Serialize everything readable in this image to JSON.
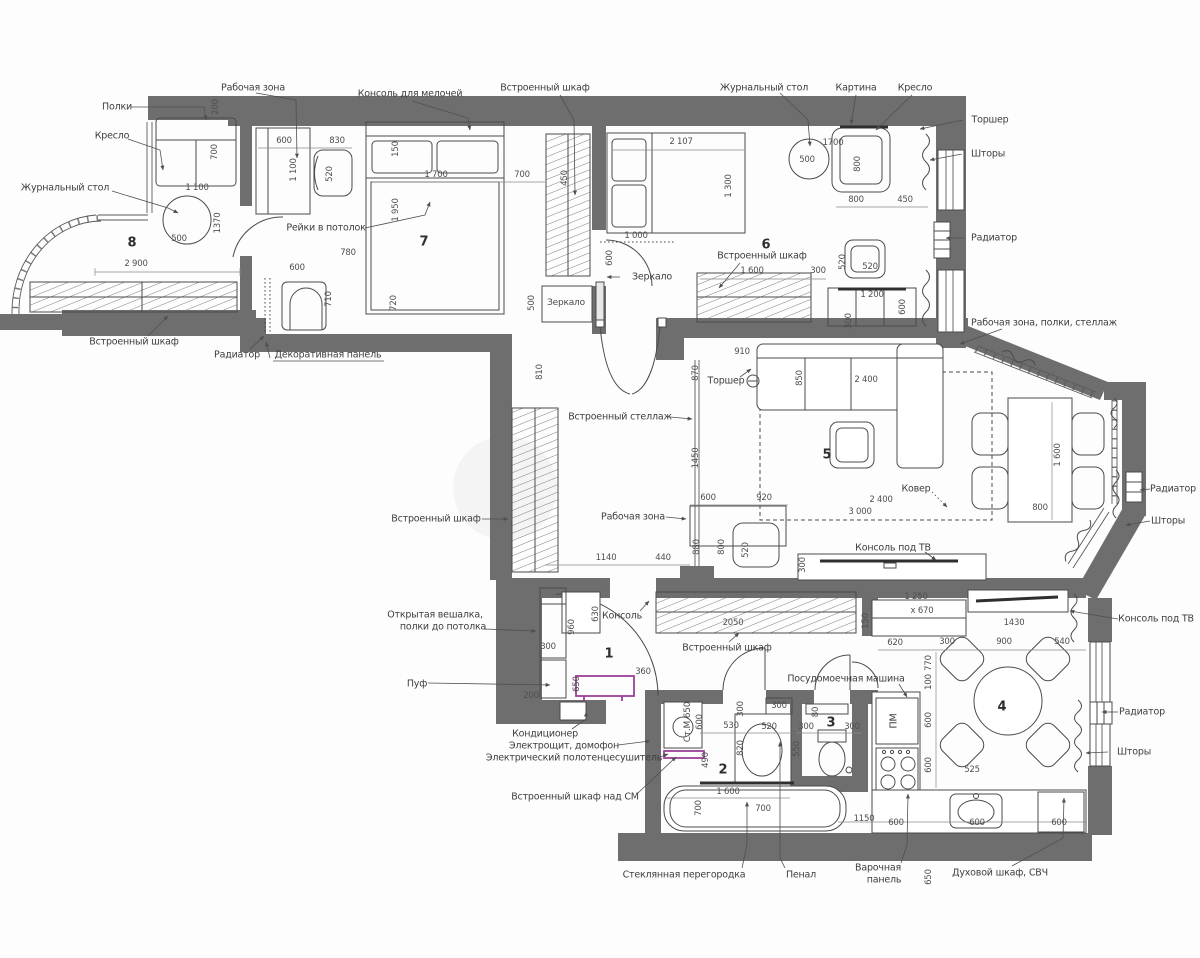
{
  "colors": {
    "wall": "#6e6e6e",
    "line": "#4b4b4b",
    "accent": "#9b3f9b",
    "background": "#fdfdfd"
  },
  "rooms": [
    {
      "n": "8",
      "x": 132,
      "y": 243
    },
    {
      "n": "7",
      "x": 424,
      "y": 242
    },
    {
      "n": "6",
      "x": 766,
      "y": 245
    },
    {
      "n": "5",
      "x": 827,
      "y": 455
    },
    {
      "n": "1",
      "x": 609,
      "y": 654
    },
    {
      "n": "2",
      "x": 723,
      "y": 770
    },
    {
      "n": "3",
      "x": 831,
      "y": 723
    },
    {
      "n": "4",
      "x": 1002,
      "y": 707
    }
  ],
  "labels": [
    {
      "t": "Полки",
      "x": 117,
      "y": 107
    },
    {
      "t": "Кресло",
      "x": 112,
      "y": 136
    },
    {
      "t": "Журнальный стол",
      "x": 65,
      "y": 188
    },
    {
      "t": "Рабочая зона",
      "x": 253,
      "y": 88
    },
    {
      "t": "Консоль для мелочей",
      "x": 410,
      "y": 94
    },
    {
      "t": "Встроенный шкаф",
      "x": 545,
      "y": 88
    },
    {
      "t": "Журнальный стол",
      "x": 764,
      "y": 88
    },
    {
      "t": "Картина",
      "x": 856,
      "y": 88
    },
    {
      "t": "Кресло",
      "x": 915,
      "y": 88
    },
    {
      "t": "Торшер",
      "x": 990,
      "y": 120
    },
    {
      "t": "Шторы",
      "x": 988,
      "y": 154
    },
    {
      "t": "Радиатор",
      "x": 994,
      "y": 238
    },
    {
      "t": "Рейки в потолок",
      "x": 326,
      "y": 228
    },
    {
      "t": "Встроенный шкаф",
      "x": 134,
      "y": 342
    },
    {
      "t": "Радиатор",
      "x": 237,
      "y": 355
    },
    {
      "t": "Декоративная панель",
      "x": 328,
      "y": 355
    },
    {
      "t": "Зеркало",
      "x": 652,
      "y": 277
    },
    {
      "t": "Зеркало",
      "x": 566,
      "y": 303,
      "cls": "small"
    },
    {
      "t": "Встроенный шкаф",
      "x": 762,
      "y": 256
    },
    {
      "t": "Рабочая зона, полки, стеллаж",
      "x": 1044,
      "y": 323
    },
    {
      "t": "Встроенный стеллаж",
      "x": 620,
      "y": 417
    },
    {
      "t": "Торшер",
      "x": 726,
      "y": 381
    },
    {
      "t": "Встроенный шкаф",
      "x": 436,
      "y": 519
    },
    {
      "t": "Рабочая зона",
      "x": 633,
      "y": 517
    },
    {
      "t": "Ковер",
      "x": 916,
      "y": 489
    },
    {
      "t": "Радиатор",
      "x": 1173,
      "y": 489
    },
    {
      "t": "Шторы",
      "x": 1168,
      "y": 521
    },
    {
      "t": "Консоль под ТВ",
      "x": 893,
      "y": 548
    },
    {
      "t": "Консоль",
      "x": 622,
      "y": 616
    },
    {
      "t": "Встроенный шкаф",
      "x": 727,
      "y": 648
    },
    {
      "t": "Консоль под ТВ",
      "x": 1156,
      "y": 619
    },
    {
      "t": "Открытая вешалка,",
      "x": 435,
      "y": 615
    },
    {
      "t": "полки до потолка",
      "x": 443,
      "y": 627
    },
    {
      "t": "Пуф",
      "x": 417,
      "y": 684
    },
    {
      "t": "Кондиционер",
      "x": 545,
      "y": 734
    },
    {
      "t": "Электрощит, домофон",
      "x": 564,
      "y": 746
    },
    {
      "t": "Электрический полотенцесушитель",
      "x": 574,
      "y": 758
    },
    {
      "t": "Встроенный шкаф над СМ",
      "x": 575,
      "y": 797
    },
    {
      "t": "Посудомоечная машина",
      "x": 846,
      "y": 679
    },
    {
      "t": "Радиатор",
      "x": 1142,
      "y": 712
    },
    {
      "t": "Шторы",
      "x": 1134,
      "y": 752
    },
    {
      "t": "Стеклянная перегородка",
      "x": 684,
      "y": 875
    },
    {
      "t": "Пенал",
      "x": 801,
      "y": 875
    },
    {
      "t": "Варочная",
      "x": 878,
      "y": 868
    },
    {
      "t": "панель",
      "x": 884,
      "y": 880
    },
    {
      "t": "Духовой шкаф, СВЧ",
      "x": 1000,
      "y": 873
    },
    {
      "t": "Ст.М 650",
      "x": 688,
      "y": 722,
      "r": 1,
      "cls": "small"
    },
    {
      "t": "ПМ",
      "x": 894,
      "y": 721,
      "r": 1
    }
  ],
  "dims": [
    {
      "t": "200",
      "x": 216,
      "y": 107,
      "r": 1
    },
    {
      "t": "700",
      "x": 215,
      "y": 152,
      "r": 1
    },
    {
      "t": "1 100",
      "x": 197,
      "y": 188
    },
    {
      "t": "500",
      "x": 179,
      "y": 239
    },
    {
      "t": "1370",
      "x": 218,
      "y": 223,
      "r": 1
    },
    {
      "t": "2 900",
      "x": 136,
      "y": 264
    },
    {
      "t": "600",
      "x": 284,
      "y": 141
    },
    {
      "t": "830",
      "x": 337,
      "y": 141
    },
    {
      "t": "1 100",
      "x": 294,
      "y": 170,
      "r": 1
    },
    {
      "t": "520",
      "x": 330,
      "y": 174,
      "r": 1
    },
    {
      "t": "150",
      "x": 396,
      "y": 149,
      "r": 1
    },
    {
      "t": "1 700",
      "x": 436,
      "y": 175
    },
    {
      "t": "700",
      "x": 522,
      "y": 175
    },
    {
      "t": "450",
      "x": 565,
      "y": 178,
      "r": 1
    },
    {
      "t": "1 950",
      "x": 396,
      "y": 210,
      "r": 1
    },
    {
      "t": "780",
      "x": 348,
      "y": 253
    },
    {
      "t": "600",
      "x": 297,
      "y": 268
    },
    {
      "t": "710",
      "x": 329,
      "y": 299,
      "r": 1
    },
    {
      "t": "720",
      "x": 394,
      "y": 303,
      "r": 1
    },
    {
      "t": "600",
      "x": 610,
      "y": 258,
      "r": 1
    },
    {
      "t": "1 000",
      "x": 636,
      "y": 236
    },
    {
      "t": "500",
      "x": 532,
      "y": 303,
      "r": 1
    },
    {
      "t": "2 107",
      "x": 681,
      "y": 142
    },
    {
      "t": "1 300",
      "x": 729,
      "y": 186,
      "r": 1
    },
    {
      "t": "1700",
      "x": 833,
      "y": 143
    },
    {
      "t": "500",
      "x": 807,
      "y": 160
    },
    {
      "t": "800",
      "x": 858,
      "y": 164,
      "r": 1
    },
    {
      "t": "800",
      "x": 856,
      "y": 200
    },
    {
      "t": "450",
      "x": 905,
      "y": 200
    },
    {
      "t": "1 600",
      "x": 752,
      "y": 271
    },
    {
      "t": "300",
      "x": 818,
      "y": 271
    },
    {
      "t": "520",
      "x": 843,
      "y": 262,
      "r": 1
    },
    {
      "t": "520",
      "x": 870,
      "y": 267
    },
    {
      "t": "1 200",
      "x": 872,
      "y": 295
    },
    {
      "t": "600",
      "x": 903,
      "y": 307,
      "r": 1
    },
    {
      "t": "300",
      "x": 849,
      "y": 321,
      "r": 1
    },
    {
      "t": "810",
      "x": 540,
      "y": 372,
      "r": 1
    },
    {
      "t": "910",
      "x": 742,
      "y": 352
    },
    {
      "t": "870",
      "x": 696,
      "y": 373,
      "r": 1
    },
    {
      "t": "1450",
      "x": 696,
      "y": 458,
      "r": 1
    },
    {
      "t": "2 400",
      "x": 866,
      "y": 380
    },
    {
      "t": "850",
      "x": 800,
      "y": 378,
      "r": 1
    },
    {
      "t": "600",
      "x": 708,
      "y": 498
    },
    {
      "t": "920",
      "x": 764,
      "y": 498
    },
    {
      "t": "2 400",
      "x": 881,
      "y": 500
    },
    {
      "t": "3 000",
      "x": 860,
      "y": 512
    },
    {
      "t": "1 600",
      "x": 1058,
      "y": 455,
      "r": 1
    },
    {
      "t": "800",
      "x": 1040,
      "y": 508
    },
    {
      "t": "880",
      "x": 697,
      "y": 547,
      "r": 1
    },
    {
      "t": "800",
      "x": 722,
      "y": 547,
      "r": 1
    },
    {
      "t": "520",
      "x": 746,
      "y": 550,
      "r": 1
    },
    {
      "t": "1140",
      "x": 606,
      "y": 558
    },
    {
      "t": "440",
      "x": 663,
      "y": 558
    },
    {
      "t": "300",
      "x": 803,
      "y": 565,
      "r": 1
    },
    {
      "t": "960",
      "x": 572,
      "y": 627,
      "r": 1
    },
    {
      "t": "630",
      "x": 596,
      "y": 614,
      "r": 1
    },
    {
      "t": "300",
      "x": 548,
      "y": 647
    },
    {
      "t": "200",
      "x": 531,
      "y": 696
    },
    {
      "t": "360",
      "x": 643,
      "y": 672
    },
    {
      "t": "650",
      "x": 577,
      "y": 684,
      "r": 1
    },
    {
      "t": "2050",
      "x": 733,
      "y": 623
    },
    {
      "t": "150",
      "x": 866,
      "y": 621,
      "r": 1
    },
    {
      "t": "600",
      "x": 700,
      "y": 722,
      "r": 1
    },
    {
      "t": "490",
      "x": 706,
      "y": 760,
      "r": 1
    },
    {
      "t": "530",
      "x": 731,
      "y": 726
    },
    {
      "t": "300",
      "x": 741,
      "y": 709,
      "r": 1
    },
    {
      "t": "820",
      "x": 741,
      "y": 748,
      "r": 1
    },
    {
      "t": "520",
      "x": 769,
      "y": 727
    },
    {
      "t": "300",
      "x": 779,
      "y": 706
    },
    {
      "t": "1 600",
      "x": 728,
      "y": 792
    },
    {
      "t": "700",
      "x": 699,
      "y": 808,
      "r": 1
    },
    {
      "t": "700",
      "x": 763,
      "y": 809
    },
    {
      "t": "300",
      "x": 806,
      "y": 727
    },
    {
      "t": "300",
      "x": 852,
      "y": 727
    },
    {
      "t": "80",
      "x": 816,
      "y": 712,
      "r": 1
    },
    {
      "t": "550",
      "x": 797,
      "y": 749,
      "r": 1
    },
    {
      "t": "1 250",
      "x": 916,
      "y": 597
    },
    {
      "t": "х 670",
      "x": 922,
      "y": 611
    },
    {
      "t": "1430",
      "x": 1014,
      "y": 623
    },
    {
      "t": "620",
      "x": 895,
      "y": 643
    },
    {
      "t": "300",
      "x": 947,
      "y": 642
    },
    {
      "t": "900",
      "x": 1004,
      "y": 642
    },
    {
      "t": "540",
      "x": 1062,
      "y": 642
    },
    {
      "t": "770",
      "x": 929,
      "y": 663,
      "r": 1
    },
    {
      "t": "100",
      "x": 929,
      "y": 682,
      "r": 1
    },
    {
      "t": "600",
      "x": 929,
      "y": 720,
      "r": 1
    },
    {
      "t": "600",
      "x": 929,
      "y": 765,
      "r": 1
    },
    {
      "t": "525",
      "x": 972,
      "y": 770
    },
    {
      "t": "1150",
      "x": 864,
      "y": 819
    },
    {
      "t": "600",
      "x": 896,
      "y": 823
    },
    {
      "t": "600",
      "x": 977,
      "y": 823
    },
    {
      "t": "600",
      "x": 1059,
      "y": 823
    },
    {
      "t": "650",
      "x": 929,
      "y": 877,
      "r": 1
    }
  ]
}
